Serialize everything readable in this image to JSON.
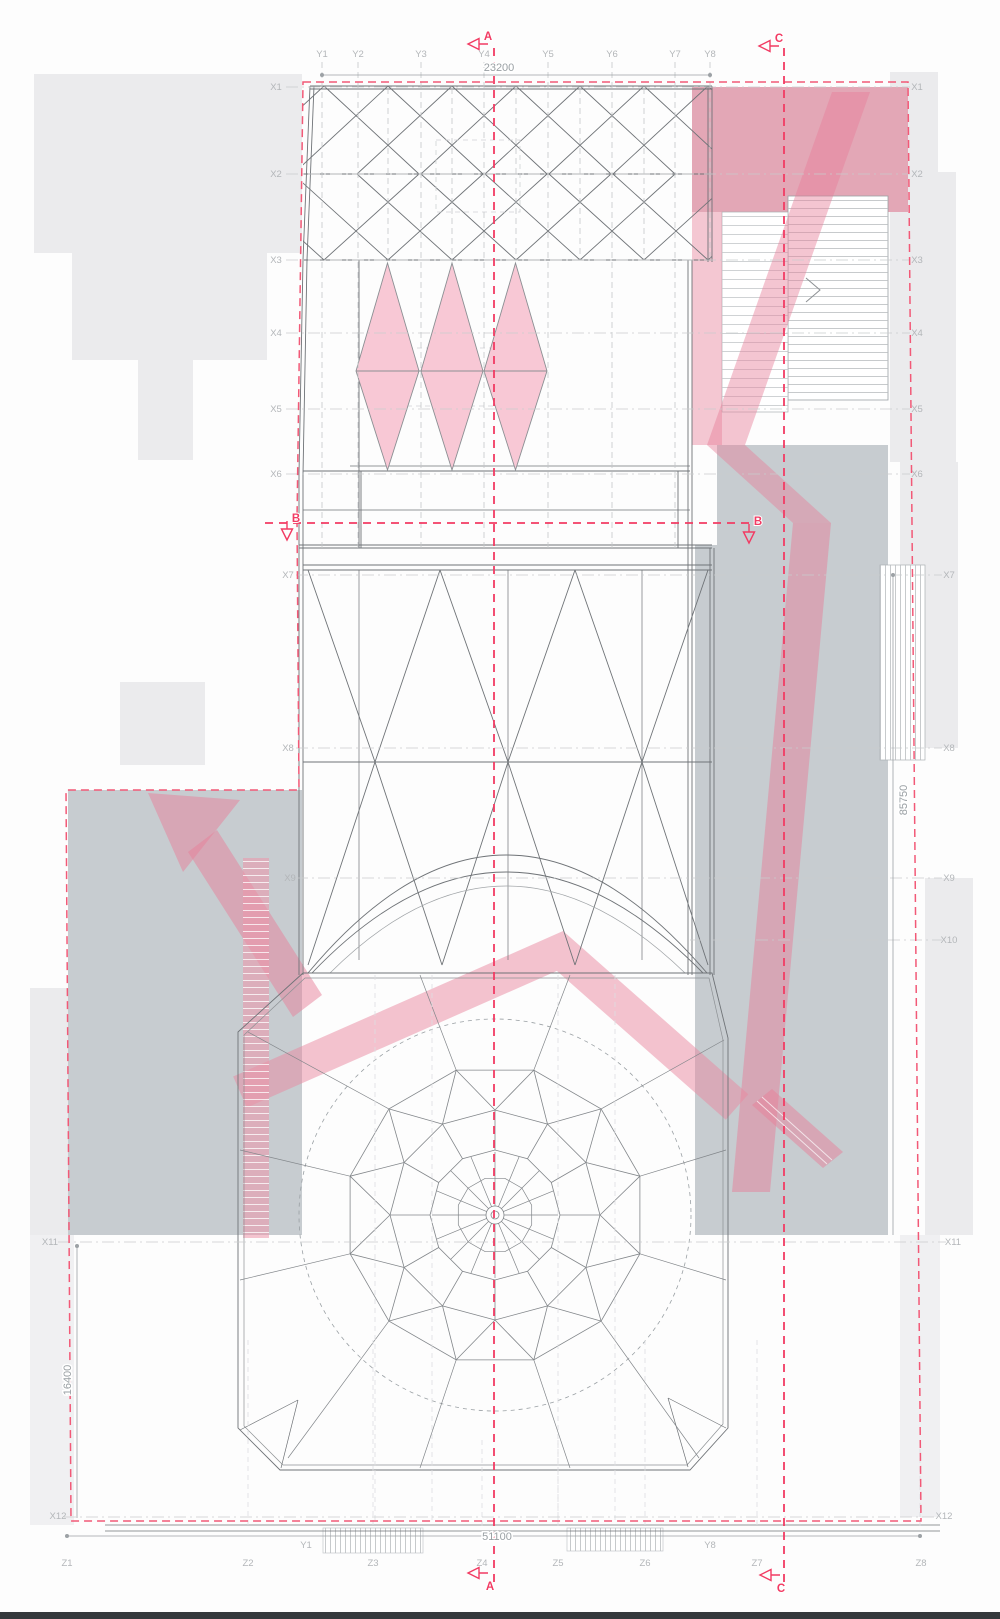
{
  "page": {
    "title": "Roof plan — architectural drawing",
    "type": "roof plan with grid axes, section lines and circulation overlays"
  },
  "palette": {
    "section_red": "#f23b63",
    "boundary_pink": "#f25977",
    "ramp_pink": "rgba(232,133,157,0.5)",
    "dark_pink_block": "#e3a7b6",
    "diamond_pink": "#f8c8d5",
    "site_gray": "#ebebed",
    "block_gray": "#c7ccd0",
    "line_gray": "#76797d",
    "grid_gray": "#c9cbcd",
    "label_gray": "#b3b6b9",
    "dim_gray": "#9aa0a4"
  },
  "grid_labels": [
    {
      "text": "Y1",
      "x": 322,
      "y": 57
    },
    {
      "text": "Y2",
      "x": 358,
      "y": 57
    },
    {
      "text": "Y3",
      "x": 421,
      "y": 57
    },
    {
      "text": "Y4",
      "x": 484,
      "y": 57
    },
    {
      "text": "Y5",
      "x": 548,
      "y": 57
    },
    {
      "text": "Y6",
      "x": 612,
      "y": 57
    },
    {
      "text": "Y7",
      "x": 675,
      "y": 57
    },
    {
      "text": "Y8",
      "x": 710,
      "y": 57
    },
    {
      "text": "X1",
      "x": 276,
      "y": 90
    },
    {
      "text": "X2",
      "x": 276,
      "y": 177
    },
    {
      "text": "X3",
      "x": 276,
      "y": 263
    },
    {
      "text": "X4",
      "x": 276,
      "y": 336
    },
    {
      "text": "X5",
      "x": 276,
      "y": 412
    },
    {
      "text": "X6",
      "x": 276,
      "y": 477
    },
    {
      "text": "X7",
      "x": 288,
      "y": 578
    },
    {
      "text": "X8",
      "x": 288,
      "y": 751
    },
    {
      "text": "X9",
      "x": 290,
      "y": 881
    },
    {
      "text": "X11",
      "x": 50,
      "y": 1245
    },
    {
      "text": "X12",
      "x": 58,
      "y": 1519
    },
    {
      "text": "X1",
      "x": 917,
      "y": 90
    },
    {
      "text": "X2",
      "x": 917,
      "y": 177
    },
    {
      "text": "X3",
      "x": 917,
      "y": 263
    },
    {
      "text": "X4",
      "x": 917,
      "y": 336
    },
    {
      "text": "X5",
      "x": 917,
      "y": 412
    },
    {
      "text": "X6",
      "x": 917,
      "y": 477
    },
    {
      "text": "X7",
      "x": 949,
      "y": 578
    },
    {
      "text": "X8",
      "x": 949,
      "y": 751
    },
    {
      "text": "X9",
      "x": 949,
      "y": 881
    },
    {
      "text": "X10",
      "x": 949,
      "y": 943
    },
    {
      "text": "X11",
      "x": 953,
      "y": 1245
    },
    {
      "text": "X12",
      "x": 944,
      "y": 1519
    },
    {
      "text": "Z1",
      "x": 67,
      "y": 1566
    },
    {
      "text": "Z2",
      "x": 248,
      "y": 1566
    },
    {
      "text": "Z3",
      "x": 373,
      "y": 1566
    },
    {
      "text": "Z4",
      "x": 482,
      "y": 1566
    },
    {
      "text": "Z5",
      "x": 558,
      "y": 1566
    },
    {
      "text": "Z6",
      "x": 645,
      "y": 1566
    },
    {
      "text": "Z7",
      "x": 757,
      "y": 1566
    },
    {
      "text": "Z8",
      "x": 921,
      "y": 1566
    },
    {
      "text": "Y1",
      "x": 306,
      "y": 1548
    },
    {
      "text": "Y8",
      "x": 710,
      "y": 1548
    }
  ],
  "dimensions": [
    {
      "value": "23200",
      "x": 499,
      "y": 71,
      "rot": 0
    },
    {
      "value": "85750",
      "x": 907,
      "y": 800,
      "rot": -90
    },
    {
      "value": "16400",
      "x": 71,
      "y": 1380,
      "rot": -90
    },
    {
      "value": "51100",
      "x": 497,
      "y": 1540,
      "rot": 0
    }
  ],
  "section_markers": [
    {
      "letter": "A",
      "lx": 488,
      "ly": 40,
      "ax": 468,
      "ay": 44,
      "dir": "left"
    },
    {
      "letter": "C",
      "lx": 779,
      "ly": 42,
      "ax": 759,
      "ay": 46,
      "dir": "left"
    },
    {
      "letter": "B",
      "lx": 296,
      "ly": 522,
      "ax": 287,
      "ay": 540,
      "dir": "down"
    },
    {
      "letter": "B",
      "lx": 758,
      "ly": 525,
      "ax": 749,
      "ay": 543,
      "dir": "down"
    },
    {
      "letter": "A",
      "lx": 490,
      "ly": 1590,
      "ax": 468,
      "ay": 1573,
      "dir": "left"
    },
    {
      "letter": "C",
      "lx": 781,
      "ly": 1592,
      "ax": 760,
      "ay": 1575,
      "dir": "left"
    }
  ]
}
